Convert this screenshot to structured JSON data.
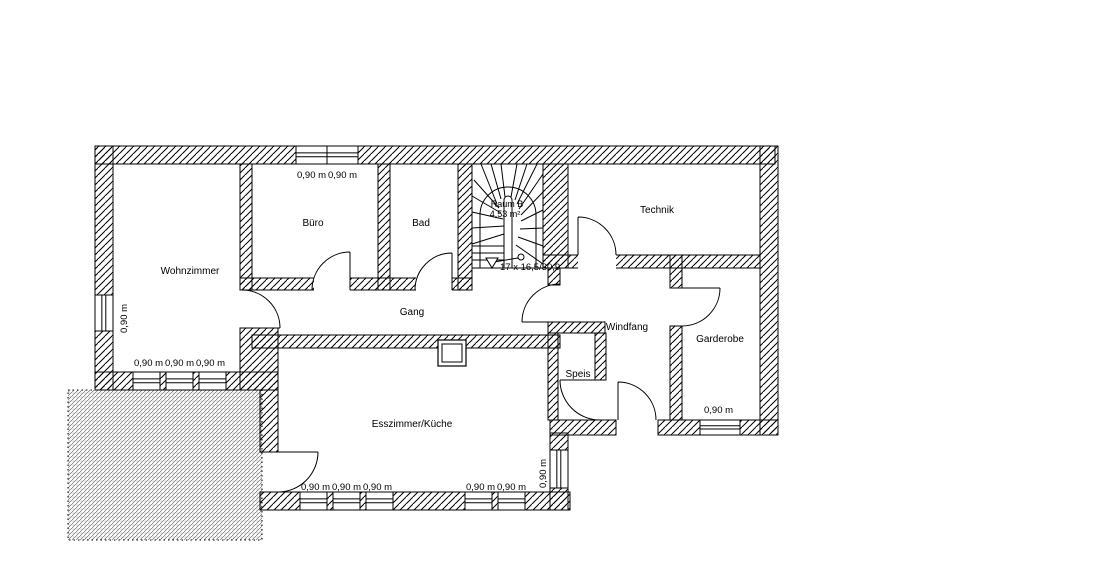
{
  "plan": {
    "rooms": {
      "wohnzimmer": "Wohnzimmer",
      "buero": "Büro",
      "bad": "Bad",
      "technik": "Technik",
      "gang": "Gang",
      "windfang": "Windfang",
      "garderobe": "Garderobe",
      "speis": "Speis",
      "esszimmer": "Esszimmer/Küche"
    },
    "stair": {
      "name": "Raum B",
      "area": "4,53 m²",
      "steps": "17 x 16,5/30,9"
    },
    "dimensions": {
      "top_windows": [
        "0,90 m",
        "0,90 m"
      ],
      "left_window": "0,90 m",
      "wohnzimmer_windows": [
        "0,90 m",
        "0,90 m",
        "0,90 m"
      ],
      "esszimmer_bottom_left_windows": [
        "0,90 m",
        "0,90 m",
        "0,90 m"
      ],
      "esszimmer_bottom_right_windows": [
        "0,90 m",
        "0,90 m"
      ],
      "esszimmer_right_window": "0,90 m",
      "garderobe_window": "0,90 m"
    },
    "colors": {
      "line": "#000000",
      "background": "#ffffff"
    }
  }
}
